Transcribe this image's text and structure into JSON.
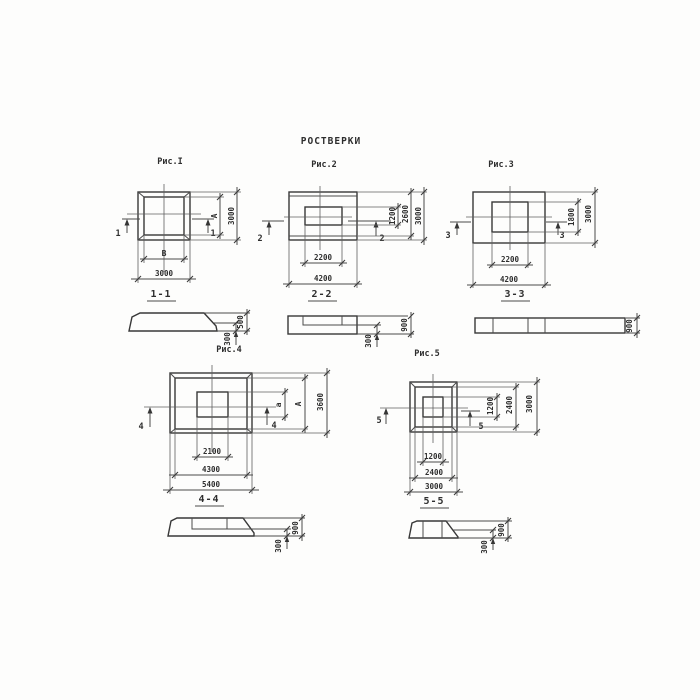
{
  "title": "РОСТВЕРКИ",
  "colors": {
    "ink": "#3c3c3c",
    "paper": "#fdfdfc"
  },
  "figures": {
    "fig1": {
      "label": "Рис.I",
      "marker": "1",
      "plan": {
        "opening_width": "В",
        "opening_height": "А",
        "outer_width": "3000",
        "outer_height": "3000"
      },
      "section": {
        "title": "1-1",
        "total_height": "500",
        "slab_height": "300"
      }
    },
    "fig2": {
      "label": "Рис.2",
      "marker": "2",
      "plan": {
        "opening_width": "2200",
        "outer_width": "4200",
        "opening_height": "1200",
        "upper_height": "2600",
        "outer_height": "3000"
      },
      "section": {
        "title": "2-2",
        "total_height": "900",
        "slab_height": "300"
      }
    },
    "fig3": {
      "label": "Рис.3",
      "marker": "3",
      "plan": {
        "opening_width": "2200",
        "outer_width": "4200",
        "opening_height": "1800",
        "outer_height": "3000"
      },
      "section": {
        "title": "3-3",
        "total_height": "900"
      }
    },
    "fig4": {
      "label": "Рис.4",
      "marker": "4",
      "plan": {
        "opening_width": "2100",
        "frame_width": "4300",
        "outer_width": "5400",
        "opening_height": "а",
        "frame_height": "А",
        "outer_height": "3600"
      },
      "section": {
        "title": "4-4",
        "total_height": "900",
        "slab_height": "300"
      }
    },
    "fig5": {
      "label": "Рис.5",
      "marker": "5",
      "plan": {
        "opening_width": "1200",
        "frame_width": "2400",
        "outer_width": "3000",
        "opening_height": "1200",
        "frame_height": "2400",
        "outer_height": "3000"
      },
      "section": {
        "title": "5-5",
        "total_height": "900",
        "slab_height": "300"
      }
    }
  }
}
